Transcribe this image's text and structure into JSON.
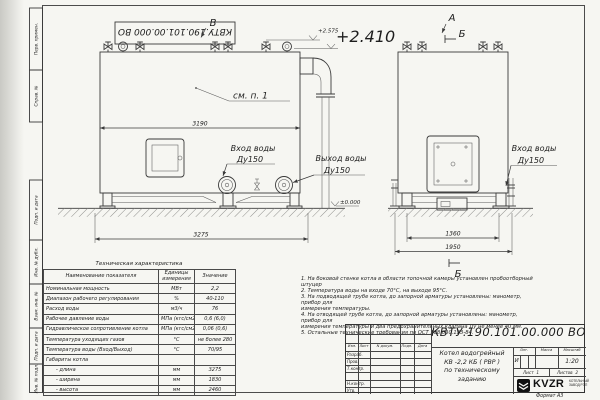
{
  "frame": {
    "doc_number_top": "КВТУ.190.101.00.000 ВО",
    "side_labels": [
      "Перв. примен.",
      "Справ. №",
      "Подп. и дата",
      "Инв. № дубл.",
      "Взам. инв. №",
      "Подп. и дата",
      "Инв. № подл."
    ],
    "format_note": "Формат  А3"
  },
  "drawing": {
    "view_arrow_b": "В",
    "view_arrow_a": "А",
    "section_mark": "Б",
    "see_note": "см. п. 1",
    "elevation_top": "+2.575",
    "elevation_mid": "+2.410",
    "elevation_zero": "±0.000",
    "inlet_label": "Вход воды",
    "inlet_dn": "Ду150",
    "outlet_label": "Выход воды",
    "outlet_dn": "Ду150",
    "inlet2_label": "Вход воды",
    "inlet2_dn": "Ду150",
    "dim_length_top": "3190",
    "dim_length_bottom": "3275",
    "dim_width_inner": "1360",
    "dim_width_outer": "1950"
  },
  "spec_table": {
    "title": "Техническая характеристика",
    "headers": [
      "Наименование показателя",
      "Единицы измерения",
      "Значение"
    ],
    "rows": [
      [
        "Номинальная мощность",
        "МВт",
        "2,2"
      ],
      [
        "Диапазон рабочего регулирования",
        "%",
        "40-110"
      ],
      [
        "Расход воды",
        "м3/ч",
        "76"
      ],
      [
        "Рабочее давление воды",
        "МПа (кгс/см2)",
        "0,6 (6,0)"
      ],
      [
        "Гидравлическое сопротивление котла",
        "МПа (кгс/см2)",
        "0,06 (0,6)"
      ],
      [
        "Температура уходящих газов",
        "°С",
        "не более 280"
      ],
      [
        "Температура воды (Вход/Выход)",
        "°С",
        "70/95"
      ],
      [
        "Габариты котла",
        "",
        ""
      ],
      [
        "- длина",
        "мм",
        "3275"
      ],
      [
        "- ширина",
        "мм",
        "1830"
      ],
      [
        "- высота",
        "мм",
        "2460"
      ]
    ]
  },
  "notes": {
    "lines": [
      "1.  На боковой стенке котла в области топочной камеры установлен пробоотборный штуцер",
      "2.  Температура воды на входе 70°С, на выходе 95°С.",
      "3.  На подводящей трубе котла, до запорной арматуры установлены: манометр, прибор для",
      "измерения температуры.",
      "4.  На отводящей трубе котла, до запорной арматуры установлены: манометр, прибор для",
      "измерения температуры и два предохранительных клапана Ду не менее 40 мм.",
      "5.  Остальные технические требования по ОСТ 108.030.133-84."
    ]
  },
  "title_block": {
    "doc_number": "КВТУ.190.101.00.000  ВО",
    "name_lines": [
      "Котел водогрейный",
      "КВ -2,2 КБ ( РВР )",
      "по техническому заданию"
    ],
    "col_headers": [
      "Изм.",
      "Лист",
      "N докум.",
      "Подп.",
      "Дата"
    ],
    "row_labels": [
      "Разраб.",
      "Пров.",
      "Т.контр.",
      "",
      "Н.контр.",
      "Утв."
    ],
    "lit_header": "Лит.",
    "mass_header": "Масса",
    "scale_header": "Масштаб",
    "lit_value": "И",
    "scale_value": "1:20",
    "sheet_label": "Лист",
    "sheet_number": "1",
    "sheets_label": "Листов",
    "sheets_number": "2",
    "logo_text": "KVZR",
    "logo_caption": [
      "КОТЕЛЬНЫЙ",
      "ЗАВОД РЭП"
    ]
  }
}
